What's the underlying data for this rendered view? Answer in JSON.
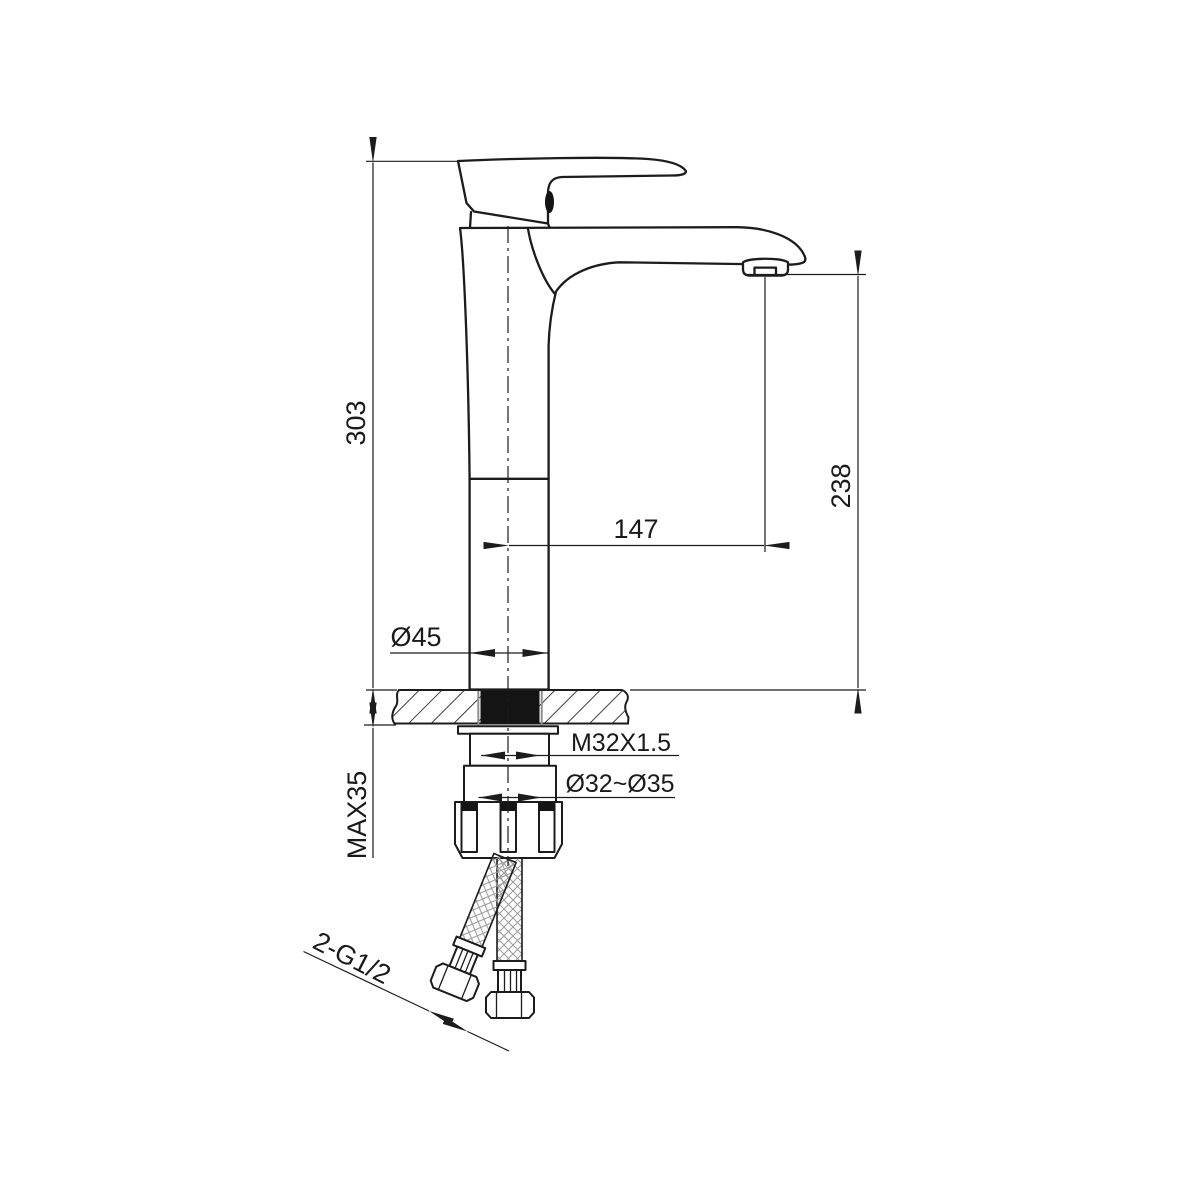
{
  "drawing": {
    "dimensions": {
      "total_height": "303",
      "spout_outlet_height": "238",
      "spout_reach": "147",
      "body_diameter": "Ø45",
      "mounting_thread": "M32X1.5",
      "mounting_hole_diameter": "Ø32~Ø35",
      "max_counter_thickness": "MAX35",
      "supply_hose_thread": "2-G1/2"
    },
    "colors": {
      "line": "#1c1c1c",
      "aux_line": "#8f8f8f",
      "solid_fill": "#141414",
      "background": "#ffffff"
    }
  }
}
